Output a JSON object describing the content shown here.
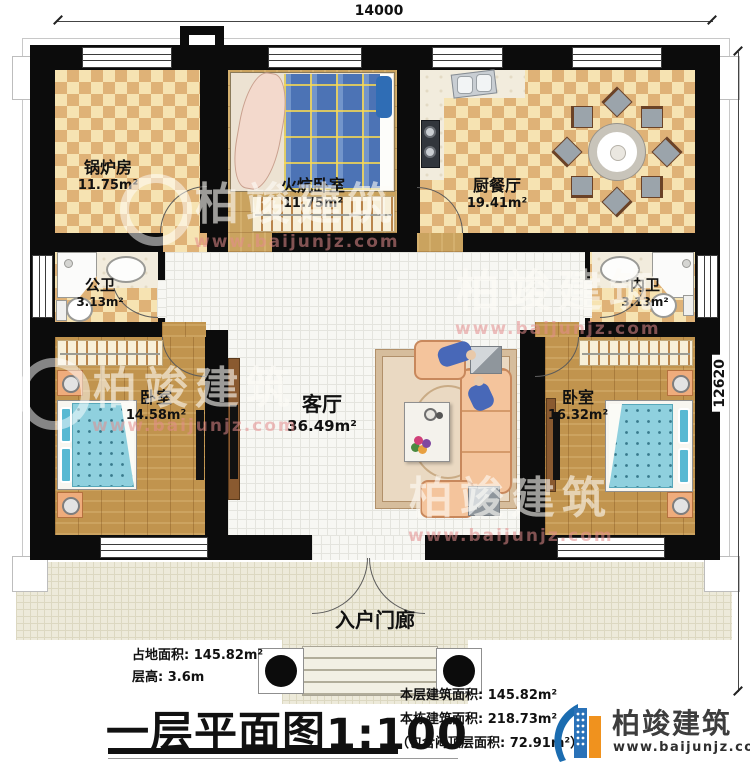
{
  "dims": {
    "width": "14000",
    "height": "12620"
  },
  "rooms": {
    "boiler": {
      "name": "锅炉房",
      "area": "11.75m²"
    },
    "kang_bedroom": {
      "name": "火炕卧室",
      "area": "11.75m²"
    },
    "kitchen_dining": {
      "name": "厨餐厅",
      "area": "19.41m²"
    },
    "public_bath": {
      "name": "公卫",
      "area": "3.13m²"
    },
    "ensuite_bath": {
      "name": "内卫",
      "area": "3.13m²"
    },
    "bedroom_left": {
      "name": "卧室",
      "area": "14.58m²"
    },
    "living": {
      "name": "客厅",
      "area": "36.49m²"
    },
    "bedroom_right": {
      "name": "卧室",
      "area": "16.32m²"
    },
    "porch": {
      "name": "入户门廊"
    }
  },
  "footer": {
    "site_area": "占地面积: 145.82m²",
    "floor_height": "层高: 3.6m",
    "title": "一层平面图",
    "scale": "1:100",
    "this_floor_area": "本层建筑面积: 145.82m²",
    "building_area": "本栋建筑面积: 218.73m²",
    "attic_note": "（包含闷顶层面积: 72.91m²）"
  },
  "brand": {
    "name": "柏竣建筑",
    "site": "www.baijunjz.com"
  },
  "colors": {
    "wall": "#0c0c0c",
    "floor_light": "#f6e3b2",
    "floor_dark": "#dfb277",
    "wood": "#c1944e",
    "bed_blue": "#8fd0de",
    "kang_blue": "#4c73b5",
    "sofa_peach": "#f4c49c",
    "brand_blue": "#1b6cb0",
    "brand_orange": "#f0921e"
  }
}
